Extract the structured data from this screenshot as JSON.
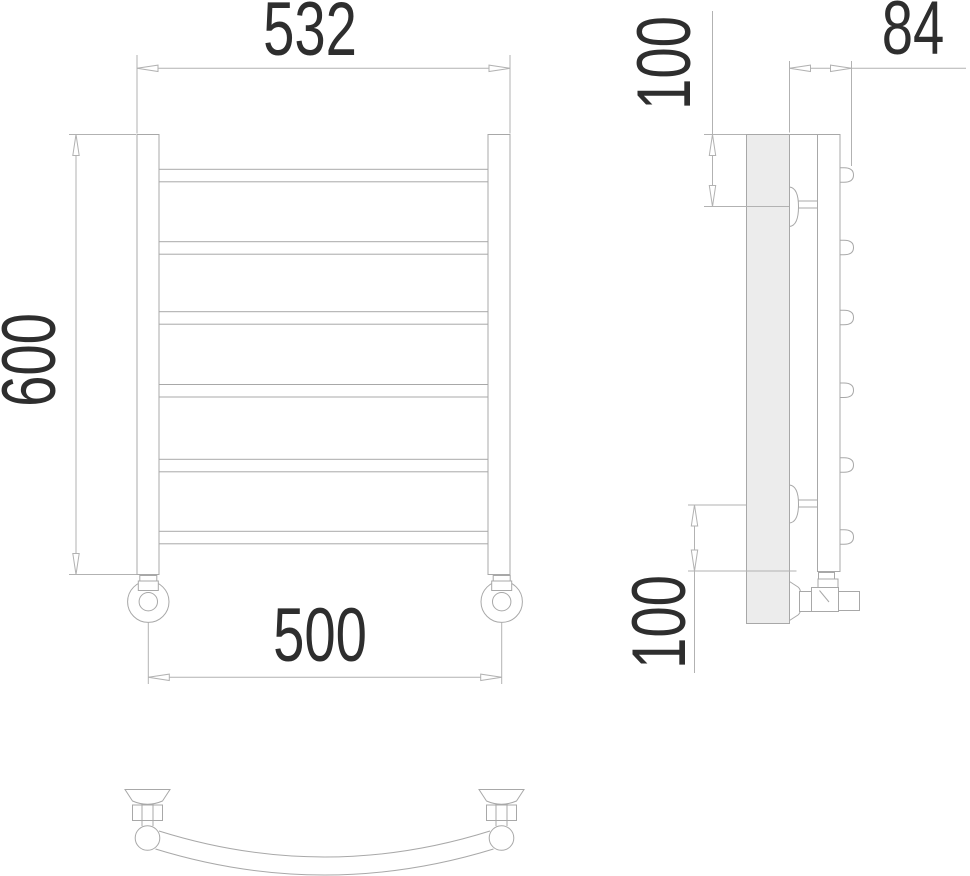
{
  "drawing": {
    "kind": "towel-rail technical drawing, three orthographic views",
    "colors": {
      "geometry_line": "#a8a8a8",
      "dimension_line": "#b2b2b2",
      "text": "#2e2e2e",
      "wall_fill": "#ececec",
      "background": "#ffffff"
    },
    "rail_bar_count": 6,
    "dimensions": {
      "overall_width": "532",
      "overall_height": "600",
      "connection_spacing": "500",
      "depth": "84",
      "top_bracket_offset": "100",
      "bottom_bracket_offset": "100"
    }
  }
}
